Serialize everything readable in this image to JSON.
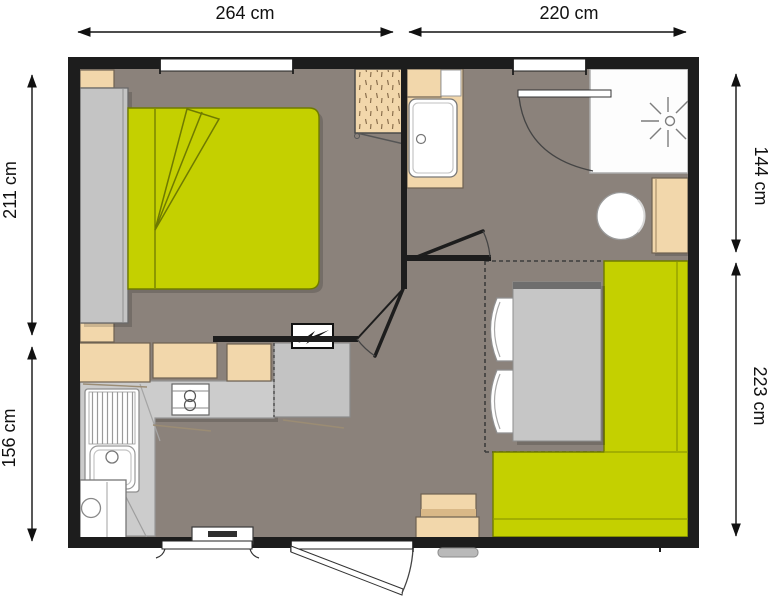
{
  "title": "mobile-home floor plan",
  "dimensions": {
    "top_left": "264 cm",
    "top_right": "220 cm",
    "left_upper": "211 cm",
    "left_lower": "156 cm",
    "right_upper": "144 cm",
    "right_lower": "223 cm"
  },
  "colors": {
    "wall": "#1d1d1d",
    "floor": "#8b827b",
    "accent_yellow": "#c4d000",
    "wood_beige": "#f2d7ab",
    "counter_gray": "#cccccc",
    "fixture_white": "#ffffff",
    "dimension_text": "#111111"
  },
  "furniture_icons": [
    "double-bed",
    "wardrobe",
    "bedside-shelf",
    "clothes-rack",
    "kitchen-wall-cabinets",
    "kitchen-counter",
    "kitchen-sink",
    "two-burner-hob",
    "fridge",
    "electric-panel",
    "washbasin",
    "shower",
    "toilet",
    "cistern-cabinet",
    "dining-table",
    "corner-bench",
    "folding-chair",
    "entry-step",
    "doormat",
    "entrance-door",
    "bathroom-door",
    "window"
  ]
}
